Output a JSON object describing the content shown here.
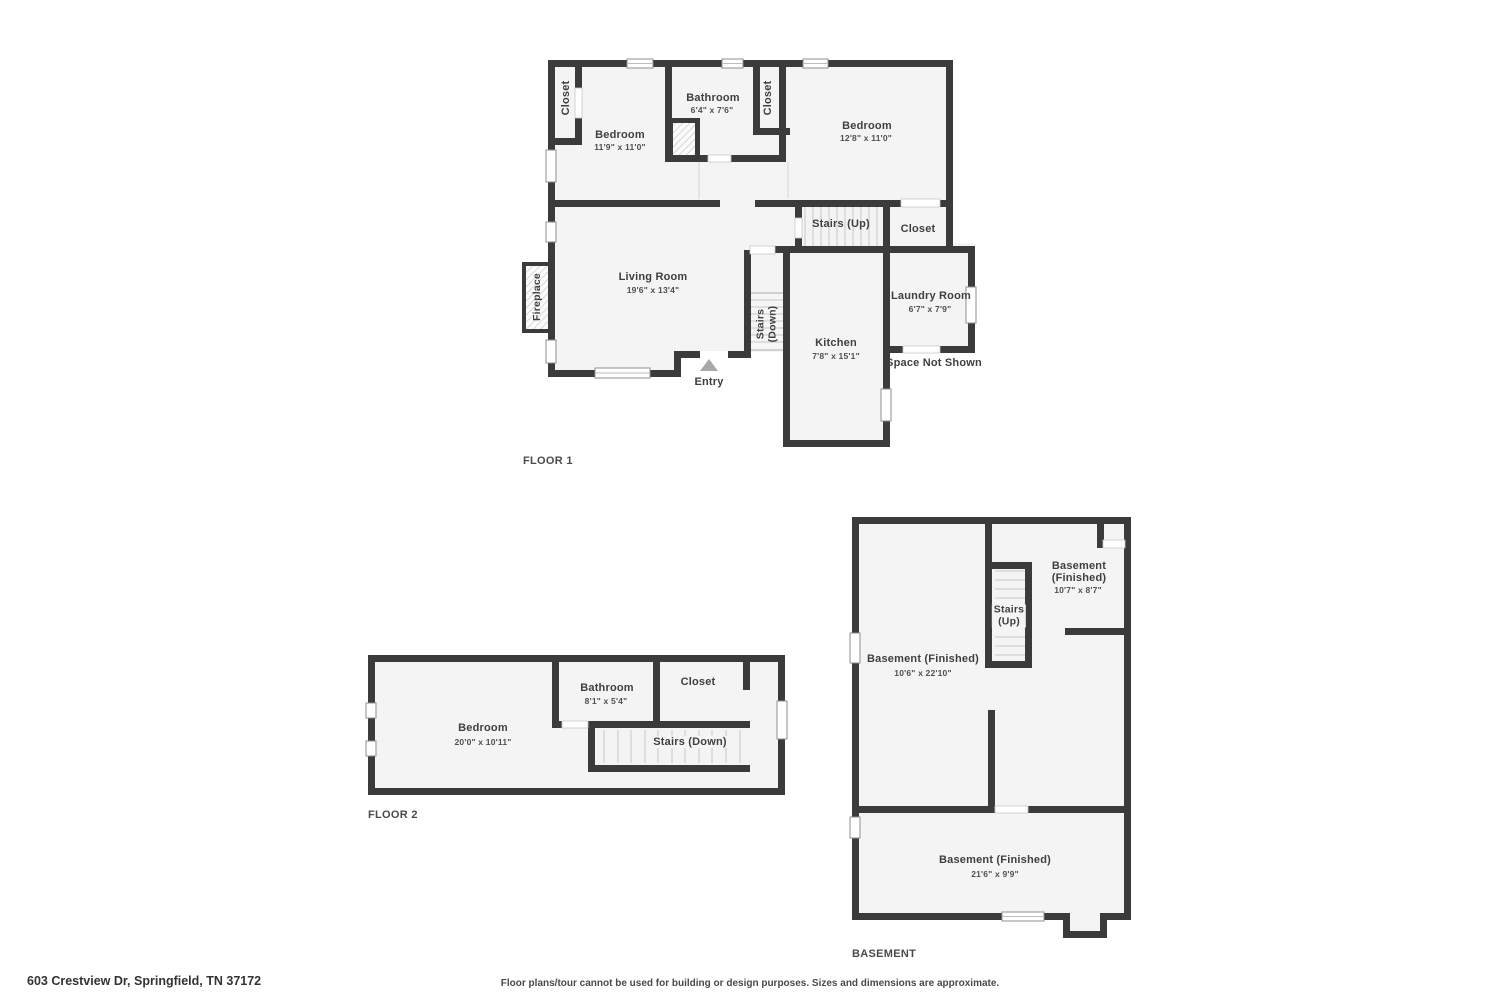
{
  "floor1": {
    "title": "FLOOR 1",
    "closet_top_left": "Closet",
    "bedroom_left": {
      "name": "Bedroom",
      "dims": "11'9\" x 11'0\""
    },
    "bathroom": {
      "name": "Bathroom",
      "dims": "6'4\" x 7'6\""
    },
    "closet_top_mid": "Closet",
    "bedroom_right": {
      "name": "Bedroom",
      "dims": "12'8\" x 11'0\""
    },
    "stairs_up": "Stairs (Up)",
    "closet_mid": "Closet",
    "living_room": {
      "name": "Living Room",
      "dims": "19'6\" x 13'4\""
    },
    "fireplace": "Fireplace",
    "stairs_down": {
      "l1": "Stairs",
      "l2": "(Down)"
    },
    "kitchen": {
      "name": "Kitchen",
      "dims": "7'8\" x 15'1\""
    },
    "laundry": {
      "name": "Laundry Room",
      "dims": "6'7\" x 7'9\""
    },
    "space_not_shown": "Space Not Shown",
    "entry": "Entry"
  },
  "floor2": {
    "title": "FLOOR 2",
    "bedroom": {
      "name": "Bedroom",
      "dims": "20'0\" x 10'11\""
    },
    "bathroom": {
      "name": "Bathroom",
      "dims": "8'1\" x 5'4\""
    },
    "closet": "Closet",
    "stairs_down": "Stairs (Down)"
  },
  "basement": {
    "title": "BASEMENT",
    "room_top_right": {
      "name": "Basement",
      "name2": "(Finished)",
      "dims": "10'7\" x 8'7\""
    },
    "stairs_up": {
      "l1": "Stairs",
      "l2": "(Up)"
    },
    "room_left": {
      "name": "Basement (Finished)",
      "dims": "10'6\" x 22'10\""
    },
    "room_bottom": {
      "name": "Basement (Finished)",
      "dims": "21'6\" x 9'9\""
    }
  },
  "footer": {
    "address": "603 Crestview Dr, Springfield, TN 37172",
    "disclaimer": "Floor plans/tour cannot be used for building or design purposes. Sizes and dimensions are approximate."
  }
}
